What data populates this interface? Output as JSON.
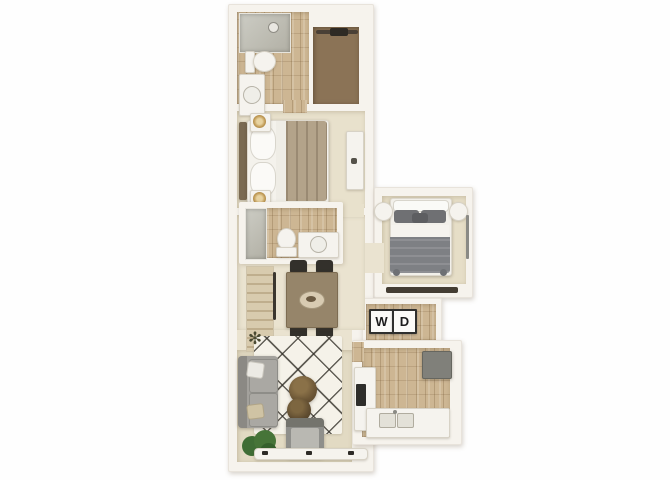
{
  "image": {
    "kind": "3d-floor-plan-top-view",
    "background": "#ffffff"
  },
  "labels": {
    "washer": "W",
    "dryer": "D"
  },
  "palette": {
    "wall": "#f6f3ed",
    "wall_edge": "#ddd6c9",
    "wood": "#cdb693",
    "carpet": "#e7dfc9",
    "carpet_bedroom1": "#e8e1cc",
    "carpet_bedroom2": "#e6dec7",
    "hall": "#eae3d0",
    "living_carpet": "#e2dac3",
    "closet_carpet": "#8b7356",
    "rug": "#f5f2e9",
    "rug_line": "#2f2c25",
    "sofa": "#a3a19c",
    "armchair": "#8f8f8b",
    "pouf": "#6b5535",
    "bed1_duvet": "#b3a38a",
    "bed2_duvet": "#7e8084",
    "bed2_pillow": "#6f7073",
    "gold": "#c09a55",
    "table": "#96856a",
    "chair": "#33302b",
    "appliance": "#80807a",
    "stove": "#2e2d2a",
    "plant_green": "#467438",
    "plant_twig": "#4a4a32",
    "stair": "#d8cbae",
    "stair_edge": "#bfae8d",
    "label_ink": "#1c1c1c"
  }
}
